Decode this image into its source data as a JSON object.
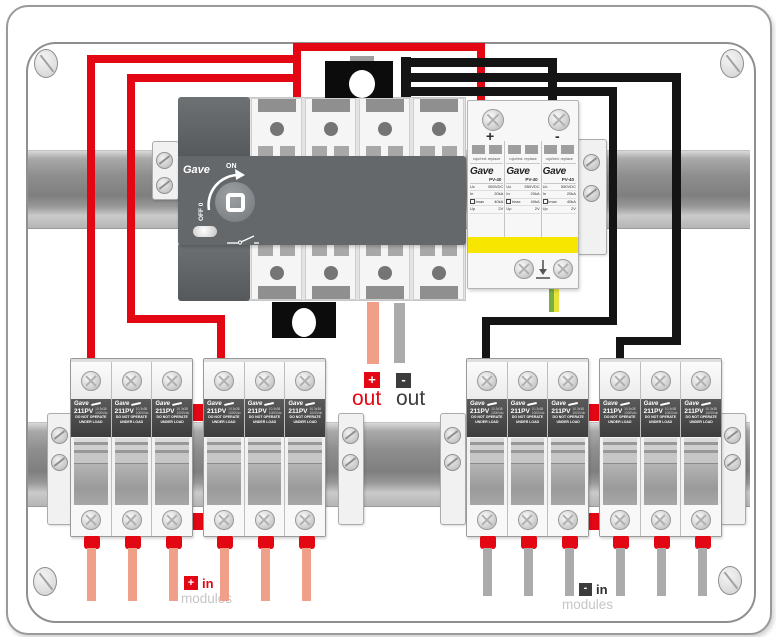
{
  "device": {
    "switch": {
      "brand": "Gave",
      "on": "ON",
      "off": "OFF 0"
    },
    "spd": {
      "plus": "+",
      "minus": "-",
      "module": {
        "replace_note": "rojo/red: replace",
        "brand": "Gave",
        "model": "PV-40",
        "spec_keys": [
          "Uc",
          "In",
          "Imax",
          "Up"
        ],
        "spec_vals": [
          "550VDC",
          "20kA",
          "40kA",
          "2V"
        ]
      }
    },
    "fuse": {
      "brand": "Gave",
      "model": "211PV",
      "size_note": "10.3x38",
      "voltage_note": "1000Vdc",
      "warning1": "DO NOT OPERATE",
      "warning2": "UNDER LOAD"
    }
  },
  "labels": {
    "out_plus_sign": "+",
    "out_plus": "out",
    "out_minus_sign": "-",
    "out_minus": "out",
    "in_plus_sign": "+",
    "in_plus": "in",
    "in_plus_modules": "modules",
    "in_minus_sign": "-",
    "in_minus": "in",
    "in_minus_modules": "modules"
  },
  "colors": {
    "positive_wire": "#e30613",
    "negative_wire": "#141414",
    "module_wire_left": "#f0a088",
    "module_wire_right": "#ababab",
    "ground_green": "#76b043",
    "ground_yellow": "#e8e23a",
    "spd_stripe": "#f6e600"
  }
}
